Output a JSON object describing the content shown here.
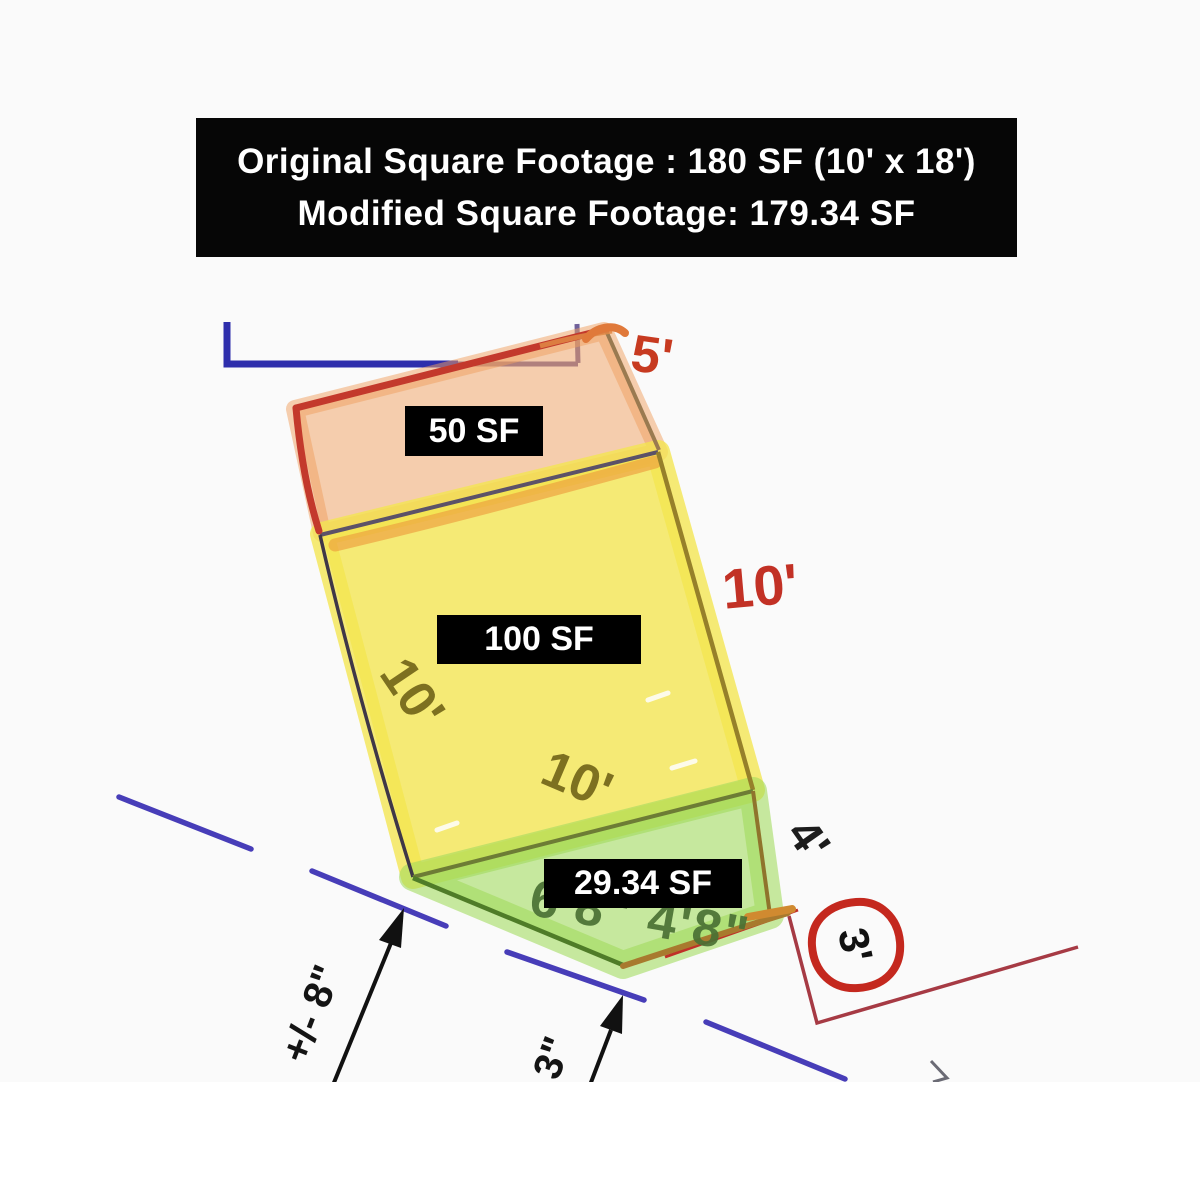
{
  "header": {
    "line1": "Original Square Footage : 180 SF (10' x 18')",
    "line2": "Modified Square Footage: 179.34 SF"
  },
  "regions": [
    {
      "name": "top strip",
      "area_label": "50 SF",
      "highlight": "#f4b377",
      "outline": "#c3392c"
    },
    {
      "name": "main square",
      "area_label": "100 SF",
      "highlight": "#f2e55e",
      "outline": "#96802a"
    },
    {
      "name": "bottom wedge",
      "area_label": "29.34 SF",
      "highlight": "#b5e37d",
      "outline": "#4f7c28"
    }
  ],
  "dimensions": {
    "top": "5'",
    "right": "10'",
    "left": "10'",
    "bottom": "10'",
    "lower_right": "4'",
    "circled": "3'",
    "underlay": "6'8\" 4'8\"",
    "offset_left": "+/- 8\"",
    "offset_middle": "3\""
  }
}
